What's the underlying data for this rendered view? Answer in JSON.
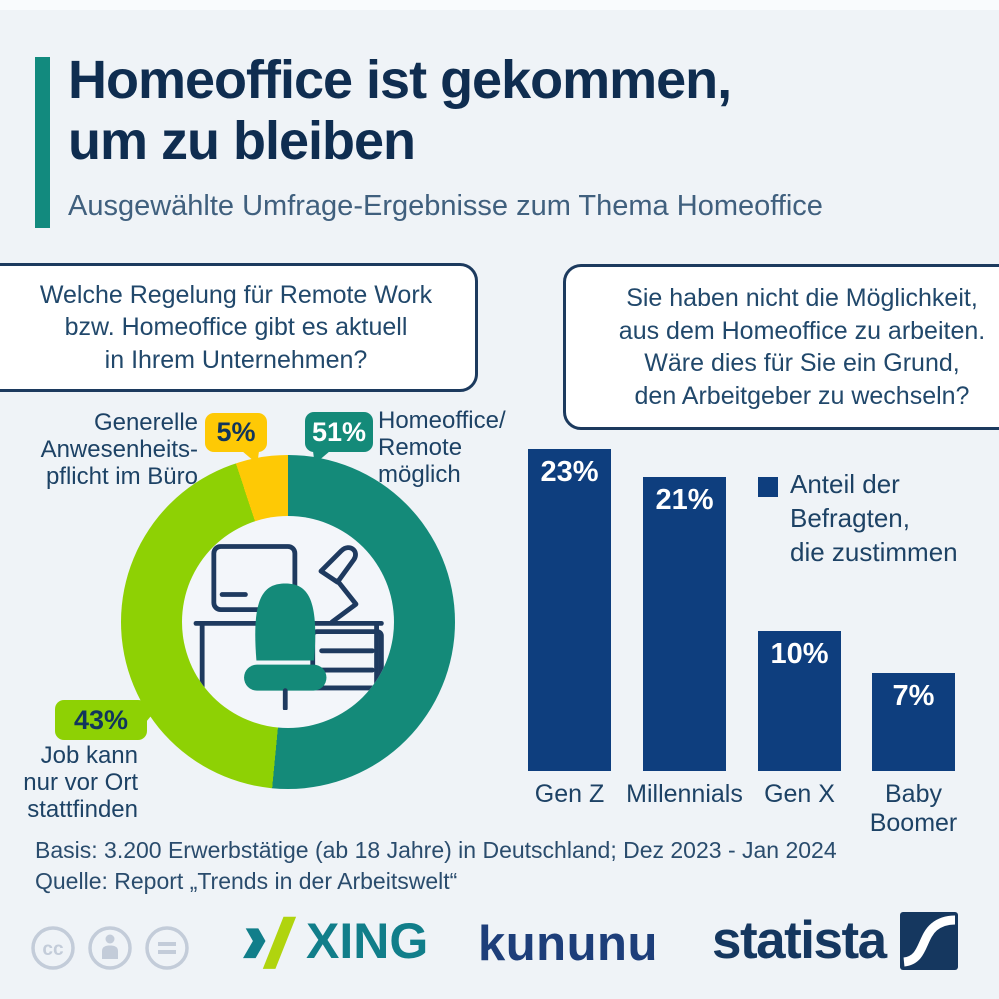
{
  "header": {
    "title": "Homeoffice ist gekommen,\num zu bleiben",
    "subtitle": "Ausgewählte Umfrage-Ergebnisse zum Thema Homeoffice"
  },
  "questions": {
    "left": "Welche Regelung für Remote Work\nbzw. Homeoffice gibt es aktuell\nin Ihrem Unternehmen?",
    "right": "Sie haben nicht die Möglichkeit,\naus dem Homeoffice zu arbeiten.\nWäre dies für Sie ein Grund,\nden Arbeitgeber zu wechseln?"
  },
  "chart_data": [
    {
      "type": "pie",
      "donut": true,
      "question": "Welche Regelung für Remote Work bzw. Homeoffice gibt es aktuell in Ihrem Unternehmen?",
      "unit": "%",
      "start_angle_deg": 0,
      "direction": "clockwise",
      "slices": [
        {
          "label": "Homeoffice/Remote möglich",
          "value": 51,
          "color": "#148a79"
        },
        {
          "label": "Job kann nur vor Ort stattfinden",
          "value": 43,
          "color": "#8ed104"
        },
        {
          "label": "Generelle Anwesenheitspflicht im Büro",
          "value": 5,
          "color": "#fec905"
        }
      ]
    },
    {
      "type": "bar",
      "question": "Sie haben nicht die Möglichkeit, aus dem Homeoffice zu arbeiten. Wäre dies für Sie ein Grund, den Arbeitgeber zu wechseln?",
      "categories": [
        "Gen Z",
        "Millennials",
        "Gen X",
        "Baby\nBoomer"
      ],
      "values": [
        23,
        21,
        10,
        7
      ],
      "unit": "%",
      "bar_color": "#0e3e7e",
      "legend": "Anteil der\nBefragten,\ndie zustimmen",
      "value_labels_inside": true,
      "ylim": [
        0,
        24
      ]
    }
  ],
  "donut_annotations": {
    "label_office": "Generelle\nAnwesenheits-\npflicht im Büro",
    "tag_office": "5%",
    "label_remote": "Homeoffice/\nRemote\nmöglich",
    "tag_remote": "51%",
    "label_onsite": "Job kann\nnur vor Ort\nstattfinden",
    "tag_onsite": "43%"
  },
  "footer": {
    "basis": "Basis: 3.200 Erwerbstätige (ab 18 Jahre) in Deutschland; Dez 2023 - Jan 2024",
    "quelle": "Quelle: Report „Trends in der Arbeitswelt“"
  },
  "logos": {
    "xing": "XING",
    "kununu": "kununu",
    "statista": "statista",
    "cc_icons": [
      "cc-license-icon",
      "attribution-person-icon",
      "equals-no-derivatives-icon"
    ]
  },
  "colors": {
    "background": "#eff3f7",
    "accent_teal": "#128a7e",
    "title_navy": "#0f2d50",
    "text_navy": "#1d4265",
    "bar_blue": "#0e3e7e",
    "donut_teal": "#148a79",
    "donut_green": "#8ed104",
    "donut_yellow": "#fec905",
    "xing_teal": "#117e8a",
    "xing_green": "#b0d40e",
    "kununu_navy": "#1d3e7a",
    "statista_navy": "#15375f"
  }
}
